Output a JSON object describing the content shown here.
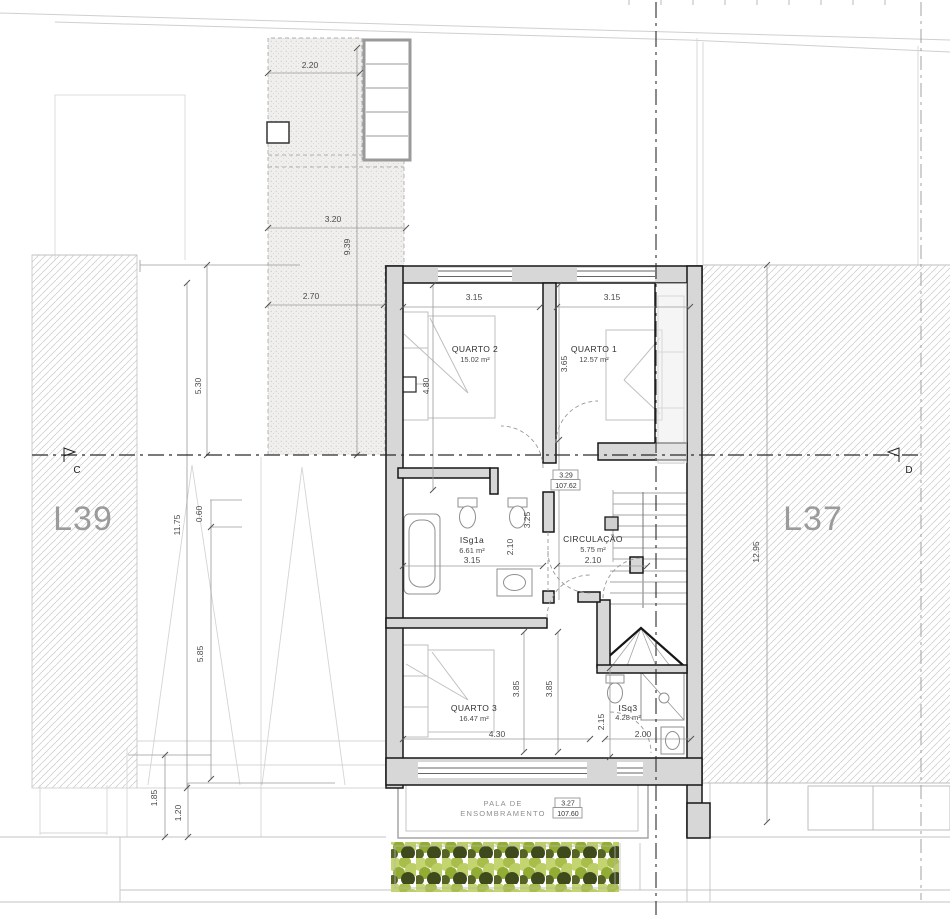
{
  "plan": {
    "lots": {
      "left": "L39",
      "right": "L37"
    },
    "markers": {
      "left": "C",
      "right": "D"
    },
    "rooms": [
      {
        "name": "QUARTO 2",
        "area": "15.02 m²"
      },
      {
        "name": "QUARTO 1",
        "area": "12.57 m²"
      },
      {
        "name": "ISg1a",
        "area": "6.61 m²"
      },
      {
        "name": "CIRCULAÇÃO",
        "area": "5.75 m²"
      },
      {
        "name": "QUARTO 3",
        "area": "16.47 m²"
      },
      {
        "name": "ISq3",
        "area": "4.28 m²"
      }
    ],
    "levels": [
      {
        "relative": "3.29",
        "absolute": "107.62"
      },
      {
        "relative": "3.27",
        "absolute": "107.60"
      }
    ],
    "canopy": {
      "line1": "PALA DE",
      "line2": "ENSOMBRAMENTO"
    },
    "dims": {
      "terrace_width_top": "2.20",
      "terrace_width_mid": "3.20",
      "terrace_length": "9.39",
      "terrace_width_bottom": "2.70",
      "quarto2_width": "3.15",
      "quarto1_width": "3.15",
      "quarto2_depth": "4.80",
      "quarto1_depth": "3.65",
      "hall_depth": "3.25",
      "isg1a_depth": "2.10",
      "isg1a_width": "3.15",
      "circulacao_width": "2.10",
      "quarto3_depth_a": "3.85",
      "quarto3_depth_b": "3.85",
      "quarto3_width": "4.30",
      "isq3_depth": "2.15",
      "isq3_width": "2.00",
      "site_left_1": "5.30",
      "site_left_2": "11.75",
      "site_left_3": "0.60",
      "site_left_4": "5.85",
      "site_left_5": "1.85",
      "site_left_6": "1.20",
      "site_right": "12.95"
    },
    "colors": {
      "wall_fill": "#d7d7d7",
      "wall_line": "#161616",
      "hedge_light": "#c3d470",
      "hedge_mid": "#a8bd4a",
      "hedge_dark": "#3f4a1c"
    }
  }
}
